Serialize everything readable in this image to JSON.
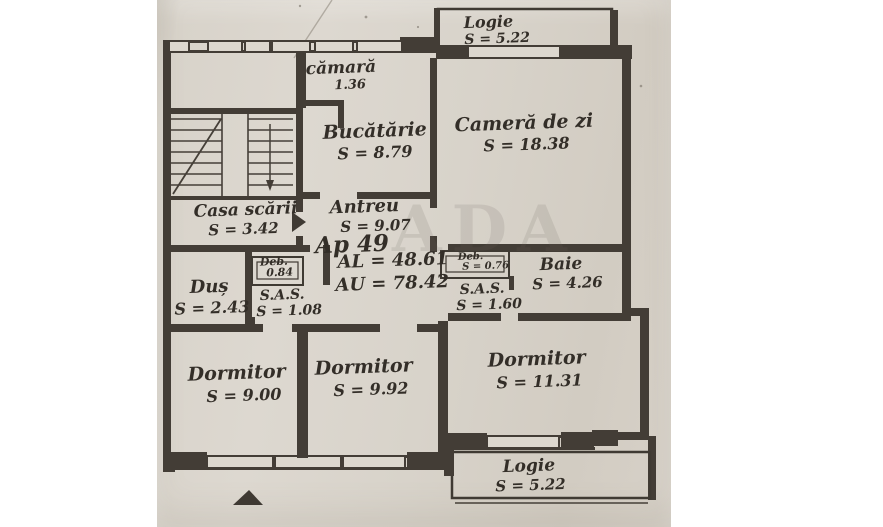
{
  "document": {
    "kind": "apartment floor plan (scanned, hand-drawn)",
    "apartment_label": "Ap 49",
    "area_built_label": "AL = 48.61",
    "area_usable_label": "AU = 78.42",
    "watermark": "ADA"
  },
  "rooms": {
    "logie_top": {
      "name": "Logie",
      "area": "S = 5.22"
    },
    "camara": {
      "name": "cămară",
      "area": "1.36"
    },
    "bucatarie": {
      "name": "Bucătărie",
      "area": "S = 8.79"
    },
    "camera_de_zi": {
      "name": "Cameră de zi",
      "area": "S = 18.38"
    },
    "casa_scarii": {
      "name": "Casa scării",
      "area": "S = 3.42"
    },
    "antreu": {
      "name": "Antreu",
      "area": "S = 9.07"
    },
    "dus": {
      "name": "Duș",
      "area": "S = 2.43"
    },
    "debara_1": {
      "name": "Deb.",
      "area": "0.84"
    },
    "sas_1": {
      "name": "S.A.S.",
      "area": "S = 1.08"
    },
    "debara_2": {
      "name": "Deb.",
      "area": "S = 0.76"
    },
    "sas_2": {
      "name": "S.A.S.",
      "area": "S = 1.60"
    },
    "baie": {
      "name": "Baie",
      "area": "S = 4.26"
    },
    "dormitor_1": {
      "name": "Dormitor",
      "area": "S = 9.00"
    },
    "dormitor_2": {
      "name": "Dormitor",
      "area": "S = 9.92"
    },
    "dormitor_3": {
      "name": "Dormitor",
      "area": "S = 11.31"
    },
    "logie_jos": {
      "name": "Logie",
      "area": "S = 5.22"
    }
  },
  "colors": {
    "paper": "#d8d3ca",
    "ink": "#433d36",
    "text": "#332e28"
  }
}
